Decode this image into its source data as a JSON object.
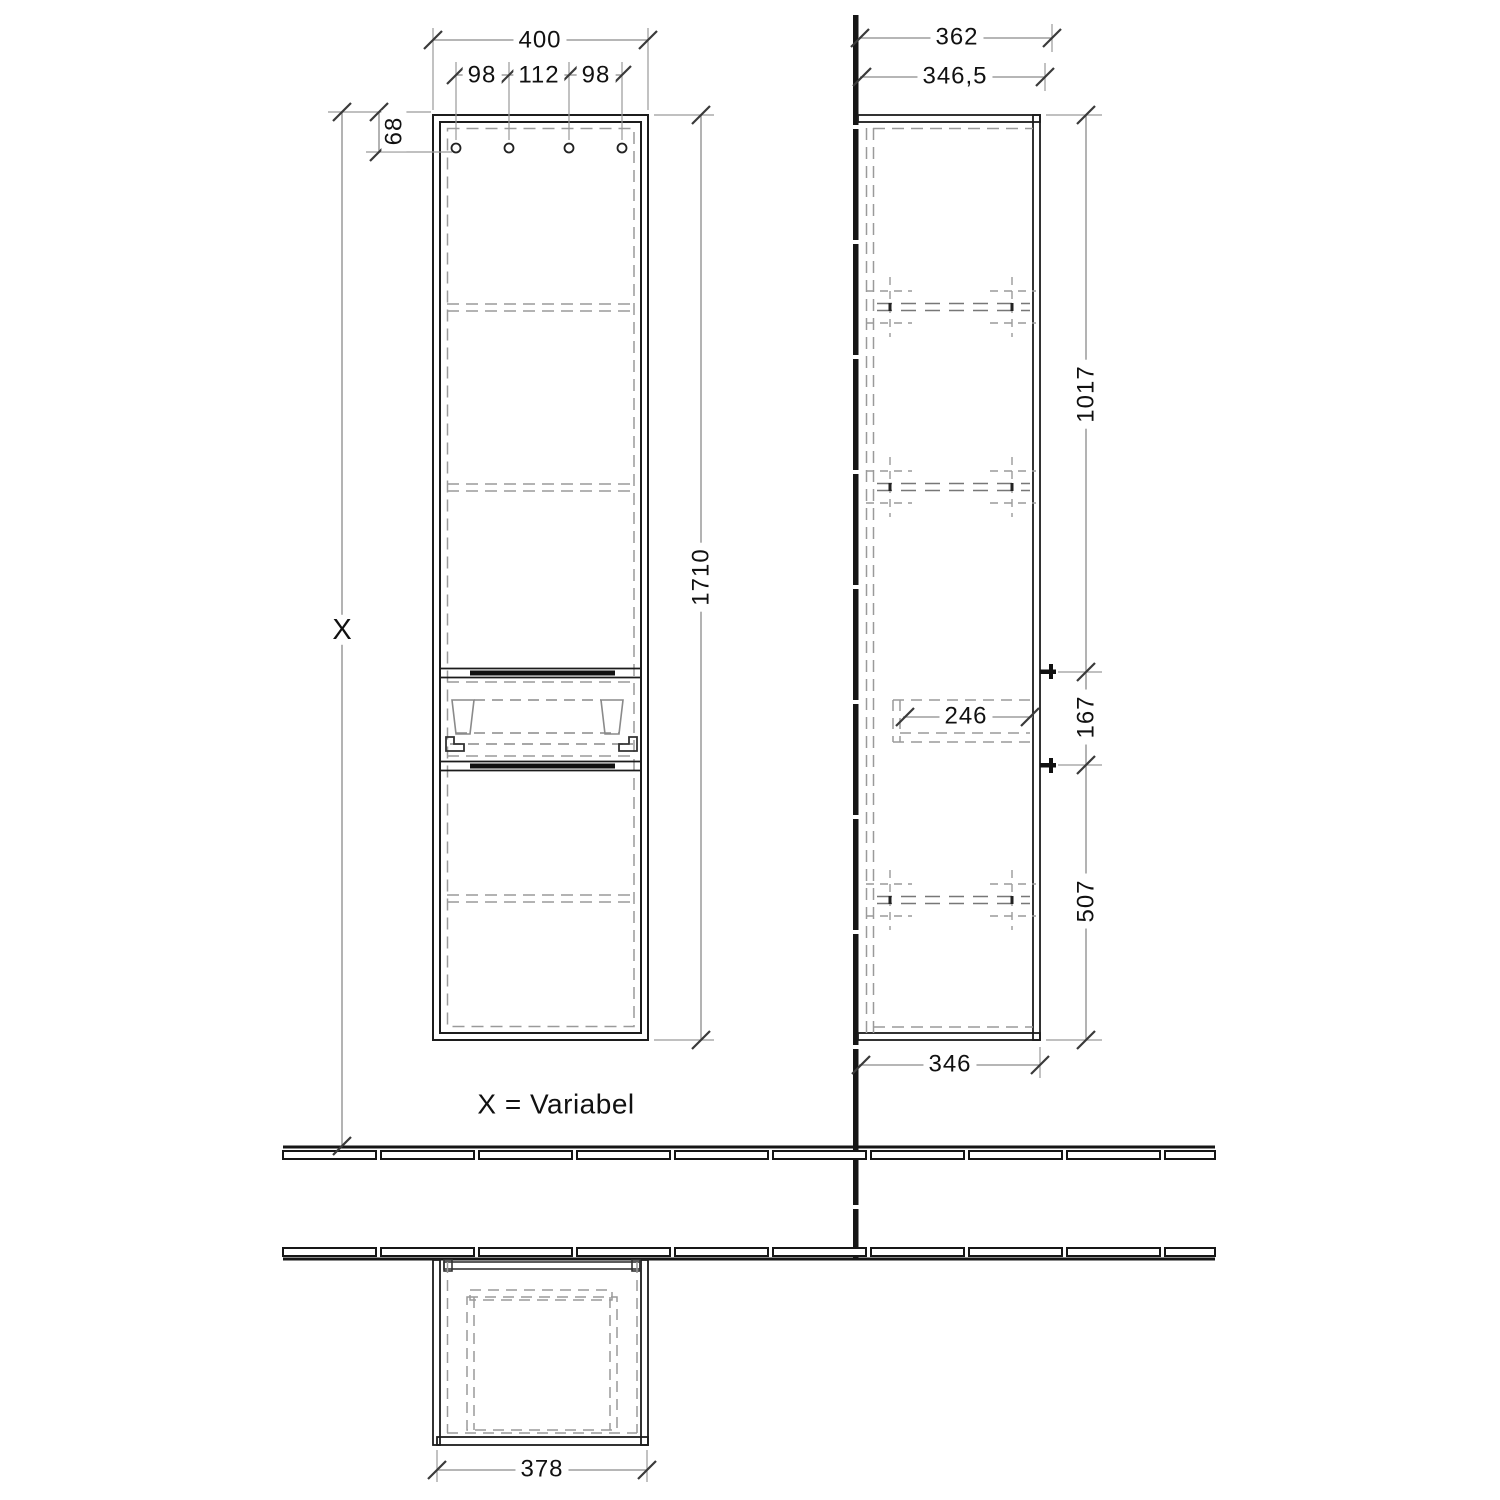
{
  "drawing": {
    "note": "X = Variabel",
    "front": {
      "total_width": "400",
      "hole_left": "98",
      "hole_center": "112",
      "hole_right": "98",
      "hole_top_offset": "68",
      "height": "1710",
      "variable_height": "X"
    },
    "side": {
      "total_depth": "362",
      "carcass_depth": "346,5",
      "upper_section_height": "1017",
      "basket_depth": "246",
      "handle_section_height": "167",
      "lower_section_height": "507",
      "bottom_depth": "346"
    },
    "top_view": {
      "width": "378"
    }
  }
}
